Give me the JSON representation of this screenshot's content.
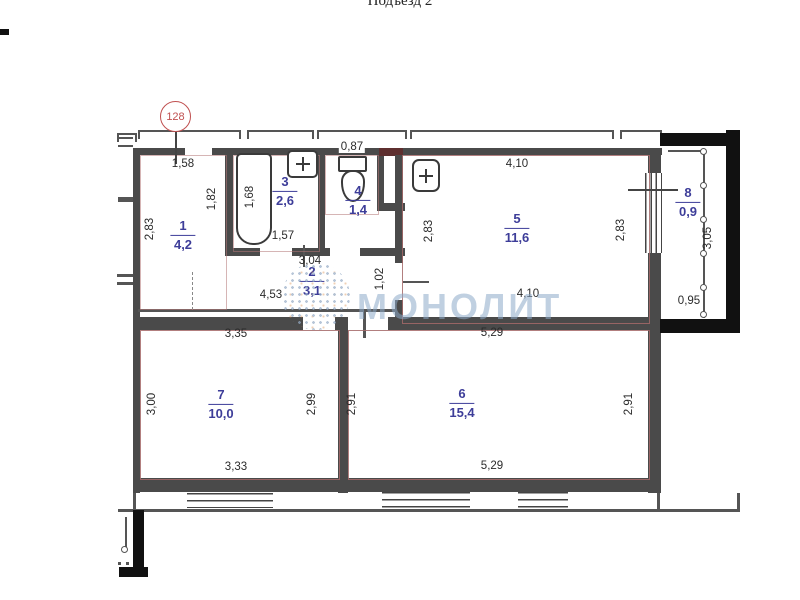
{
  "title": "Подъезд 2",
  "apartment_number": "128",
  "watermark": "МОНОЛИТ",
  "colors": {
    "accent_red": "#c05050",
    "room_label_blue": "#3d3d99",
    "wall_dark": "#4a4a4a",
    "wall_red_outline": "#a56868",
    "watermark_blue": "#8caac8"
  },
  "rooms": [
    {
      "number": "1",
      "area": "4,2",
      "x": 183,
      "y": 235
    },
    {
      "number": "2",
      "area": "3,1",
      "x": 312,
      "y": 281
    },
    {
      "number": "3",
      "area": "2,6",
      "x": 285,
      "y": 191
    },
    {
      "number": "4",
      "area": "1,4",
      "x": 358,
      "y": 200
    },
    {
      "number": "5",
      "area": "11,6",
      "x": 517,
      "y": 228
    },
    {
      "number": "6",
      "area": "15,4",
      "x": 462,
      "y": 403
    },
    {
      "number": "7",
      "area": "10,0",
      "x": 221,
      "y": 404
    },
    {
      "number": "8",
      "area": "0,9",
      "x": 688,
      "y": 202
    }
  ],
  "dimensions": [
    {
      "text": "1,58",
      "x": 183,
      "y": 164,
      "dir": "h"
    },
    {
      "text": "1,82",
      "x": 212,
      "y": 199,
      "dir": "v"
    },
    {
      "text": "2,83",
      "x": 150,
      "y": 229,
      "dir": "v"
    },
    {
      "text": "1,68",
      "x": 250,
      "y": 197,
      "dir": "v"
    },
    {
      "text": "1,57",
      "x": 283,
      "y": 236,
      "dir": "h"
    },
    {
      "text": "0,87",
      "x": 352,
      "y": 147,
      "dir": "h",
      "bg": true
    },
    {
      "text": "3,04",
      "x": 310,
      "y": 261,
      "dir": "h"
    },
    {
      "text": "4,53",
      "x": 271,
      "y": 295,
      "dir": "h"
    },
    {
      "text": "1,02",
      "x": 380,
      "y": 279,
      "dir": "v"
    },
    {
      "text": "2,83",
      "x": 429,
      "y": 231,
      "dir": "v"
    },
    {
      "text": "4,10",
      "x": 517,
      "y": 164,
      "dir": "h"
    },
    {
      "text": "2,83",
      "x": 621,
      "y": 230,
      "dir": "v"
    },
    {
      "text": "4,10",
      "x": 528,
      "y": 294,
      "dir": "h"
    },
    {
      "text": "3,35",
      "x": 236,
      "y": 334,
      "dir": "h"
    },
    {
      "text": "5,29",
      "x": 492,
      "y": 333,
      "dir": "h"
    },
    {
      "text": "3,00",
      "x": 152,
      "y": 404,
      "dir": "v"
    },
    {
      "text": "2,99",
      "x": 312,
      "y": 404,
      "dir": "v"
    },
    {
      "text": "2,91",
      "x": 352,
      "y": 404,
      "dir": "v"
    },
    {
      "text": "2,91",
      "x": 629,
      "y": 404,
      "dir": "v"
    },
    {
      "text": "3,33",
      "x": 236,
      "y": 467,
      "dir": "h"
    },
    {
      "text": "5,29",
      "x": 492,
      "y": 466,
      "dir": "h"
    },
    {
      "text": "3,05",
      "x": 708,
      "y": 238,
      "dir": "v"
    },
    {
      "text": "0,95",
      "x": 689,
      "y": 301,
      "dir": "h"
    }
  ],
  "fixtures": [
    "bathtub-icon",
    "toilet-icon",
    "bath-sink-icon",
    "kitchen-sink-icon",
    "balcony-railing-icon"
  ]
}
